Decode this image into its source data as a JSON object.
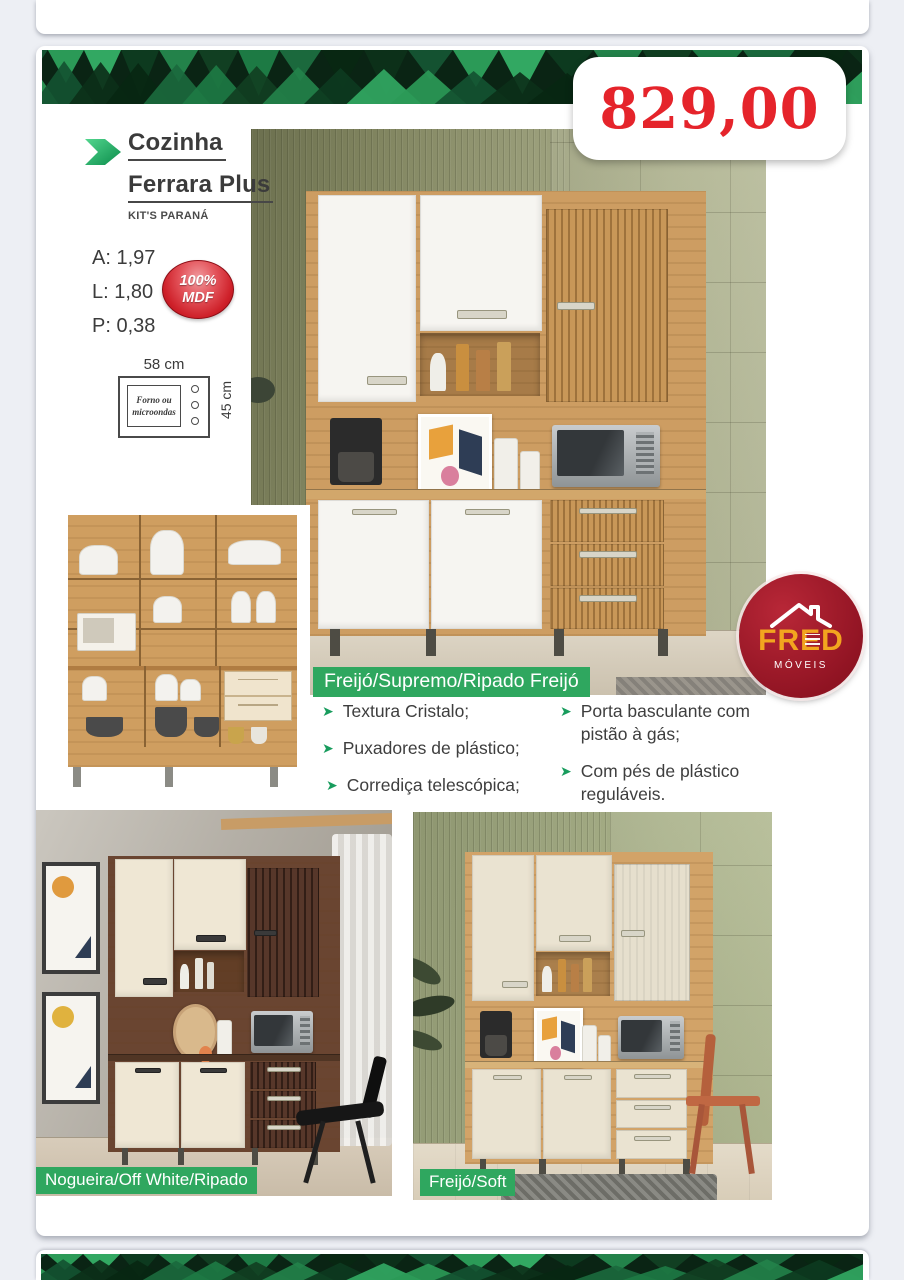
{
  "price_tag": {
    "value": "829,00"
  },
  "product": {
    "title_line1": "Cozinha",
    "title_line2": "Ferrara Plus",
    "brand": "KIT'S PARANÁ"
  },
  "specs": {
    "height": "A: 1,97",
    "width": "L: 1,80",
    "depth": "P: 0,38"
  },
  "mdf_badge": {
    "line1": "100%",
    "line2": "MDF"
  },
  "oven_diagram": {
    "width_label": "58 cm",
    "height_label": "45 cm",
    "slot_line1": "Forno ou",
    "slot_line2": "microondas"
  },
  "variants": {
    "main": "Freijó/Supremo/Ripado Freijó",
    "bottom_left": "Nogueira/Off White/Ripado",
    "bottom_right": "Freijó/Soft"
  },
  "features": {
    "left": [
      "Textura Cristalo;",
      "Puxadores de plástico;",
      "Corrediça telescópica;"
    ],
    "right": [
      "Porta basculante com pistão à gás;",
      "Com pés de plástico reguláveis."
    ]
  },
  "store_logo": {
    "name": "FRED",
    "subtitle": "MÓVEIS"
  },
  "colors": {
    "accent_green": "#2fa75f",
    "price_red": "#e5242b",
    "banner_green_dark": "#0a2414",
    "banner_green_light": "#2b9a57",
    "logo_red": "#9b1422",
    "logo_orange": "#f2a51f"
  }
}
